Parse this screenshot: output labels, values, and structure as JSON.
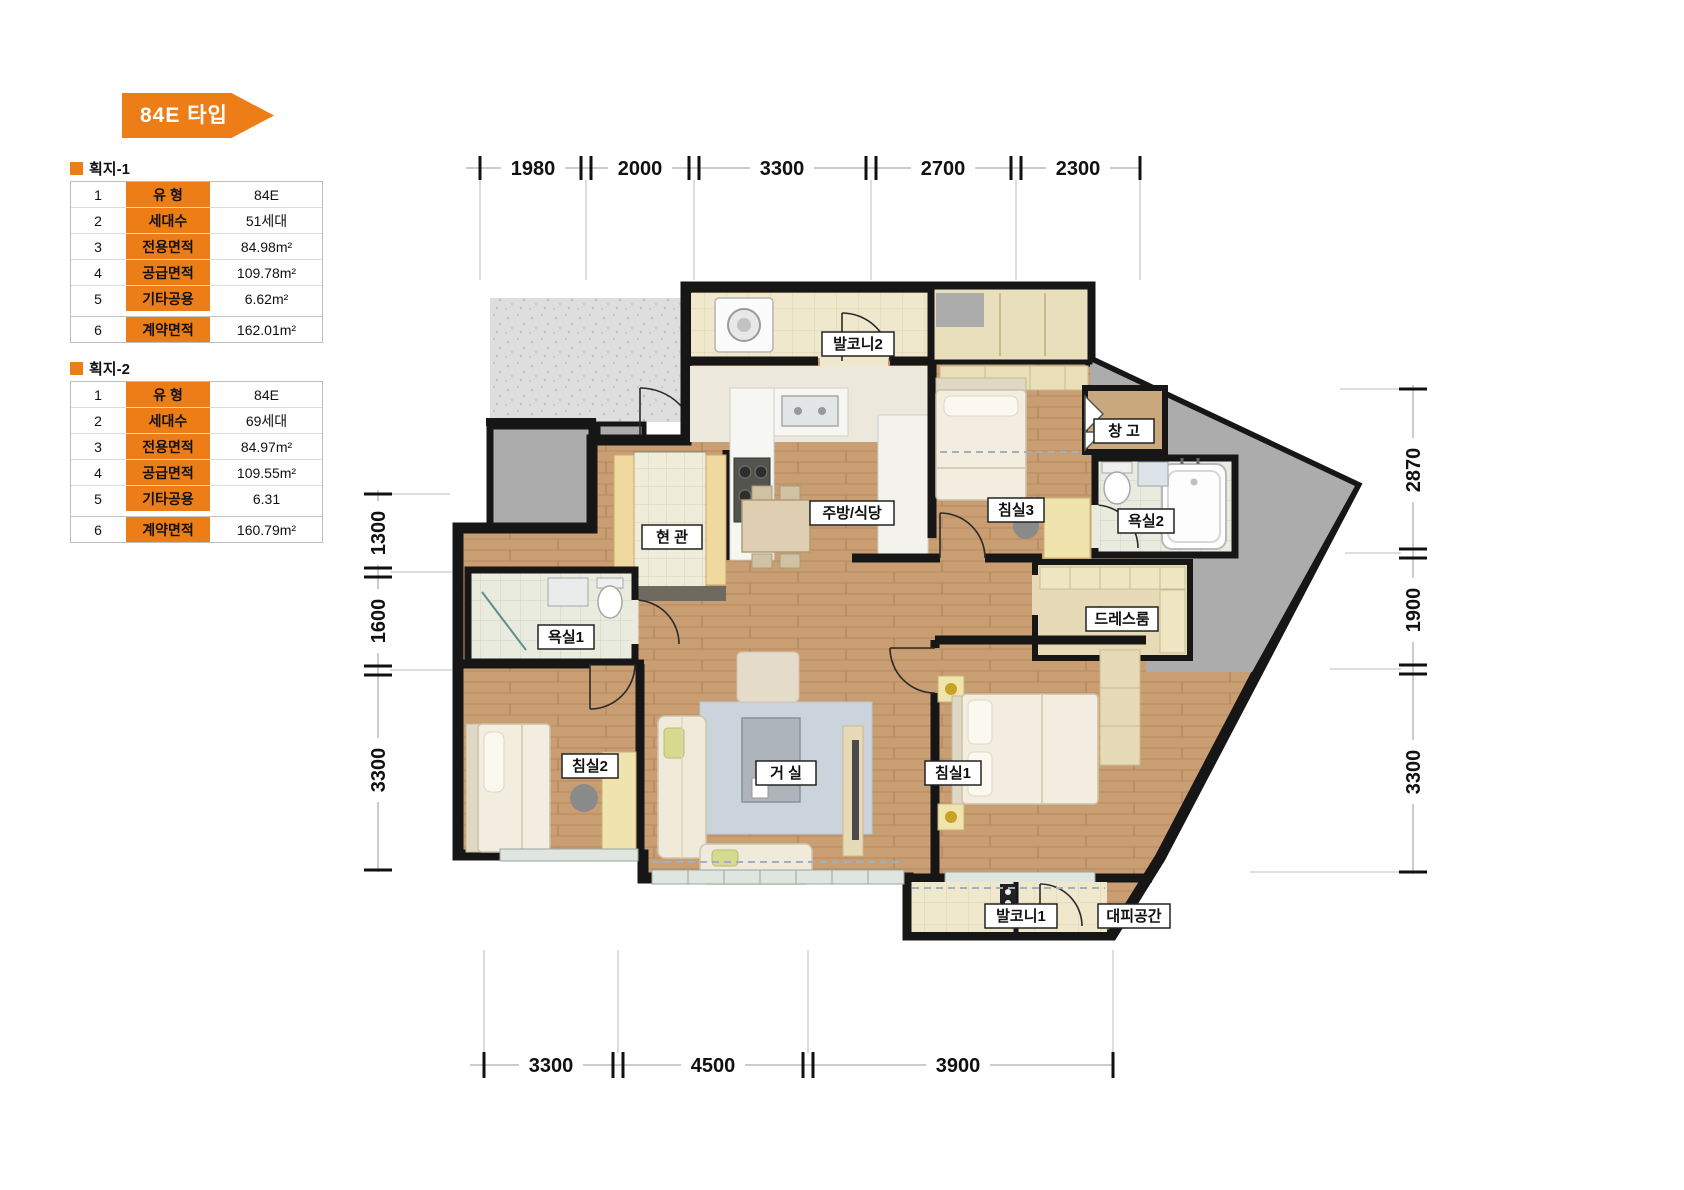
{
  "title": {
    "badge": "84E 타입"
  },
  "tables": [
    {
      "section": "획지-1",
      "rows": [
        [
          "1",
          "유 형",
          "84E"
        ],
        [
          "2",
          "세대수",
          "51세대"
        ],
        [
          "3",
          "전용면적",
          "84.98m²"
        ],
        [
          "4",
          "공급면적",
          "109.78m²"
        ],
        [
          "5",
          "기타공용",
          "6.62m²"
        ],
        [
          "6",
          "계약면적",
          "162.01m²"
        ]
      ]
    },
    {
      "section": "획지-2",
      "rows": [
        [
          "1",
          "유 형",
          "84E"
        ],
        [
          "2",
          "세대수",
          "69세대"
        ],
        [
          "3",
          "전용면적",
          "84.97m²"
        ],
        [
          "4",
          "공급면적",
          "109.55m²"
        ],
        [
          "5",
          "기타공용",
          "6.31"
        ],
        [
          "6",
          "계약면적",
          "160.79m²"
        ]
      ]
    }
  ],
  "plan": {
    "rooms": [
      {
        "label": "발코니2"
      },
      {
        "label": "주방/식당"
      },
      {
        "label": "침실3"
      },
      {
        "label": "창 고"
      },
      {
        "label": "욕실2"
      },
      {
        "label": "드레스룸"
      },
      {
        "label": "현 관"
      },
      {
        "label": "욕실1"
      },
      {
        "label": "침실2"
      },
      {
        "label": "거 실"
      },
      {
        "label": "침실1"
      },
      {
        "label": "발코니1"
      },
      {
        "label": "대피공간"
      }
    ],
    "dimensions": {
      "top": [
        "1980",
        "2000",
        "3300",
        "2700",
        "2300"
      ],
      "bottom": [
        "3300",
        "4500",
        "3900"
      ],
      "left": [
        "1300",
        "1600",
        "3300"
      ],
      "right": [
        "2870",
        "1900",
        "3300"
      ]
    }
  },
  "colors": {
    "accent": "#ED7D17",
    "wall": "#161616",
    "wood": "#C99E73",
    "tile": "#E9EBDF",
    "balcony": "#EFE8CC",
    "core_gray": "#ACACAC"
  }
}
